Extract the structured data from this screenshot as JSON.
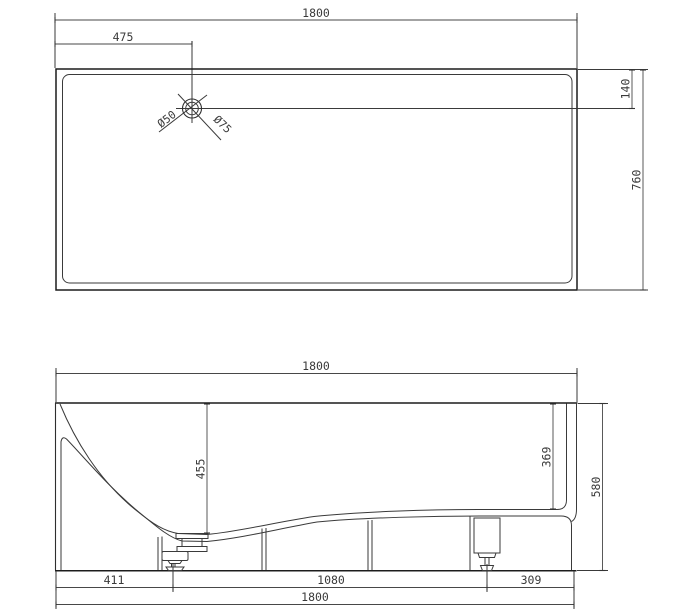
{
  "top_view": {
    "width": "1800",
    "drain_from_left": "475",
    "drain_from_top": "140",
    "depth": "760",
    "drain_hole_diameter": "Ø50",
    "drain_flange_diameter": "Ø75"
  },
  "side_view": {
    "width": "1800",
    "interior_depth_at_drain": "455",
    "interior_depth_right": "369",
    "height": "580",
    "left_foot_offset": "411",
    "feet_spacing": "1080",
    "right_foot_offset": "309",
    "base_width": "1800"
  },
  "colors": {
    "background": "#ffffff",
    "line": "#3a3a3a",
    "text": "#3a3a3a"
  }
}
